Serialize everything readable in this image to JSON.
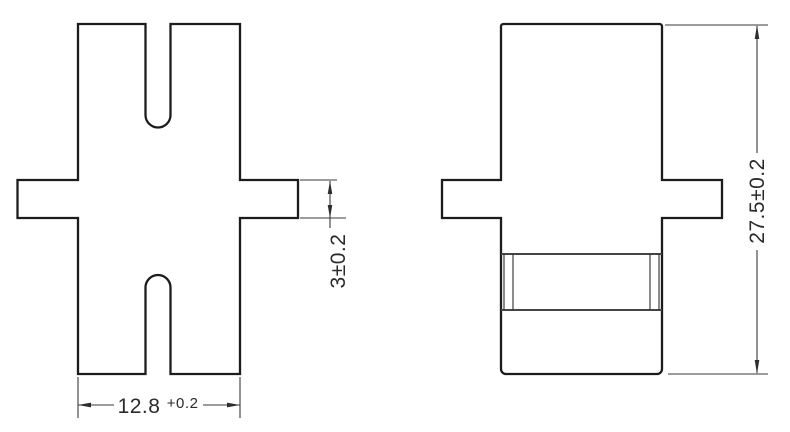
{
  "drawing": {
    "colors": {
      "background": "#ffffff",
      "outline": "#1c1c1c",
      "dimension_lines": "#3a3a3a",
      "text": "#2b2b2b"
    },
    "dimensions": {
      "width": {
        "value": "12.8",
        "tolerance": "+0.2"
      },
      "flange_thickness": {
        "value": "3±0.2"
      },
      "height": {
        "value": "27.5±0.2"
      }
    }
  }
}
